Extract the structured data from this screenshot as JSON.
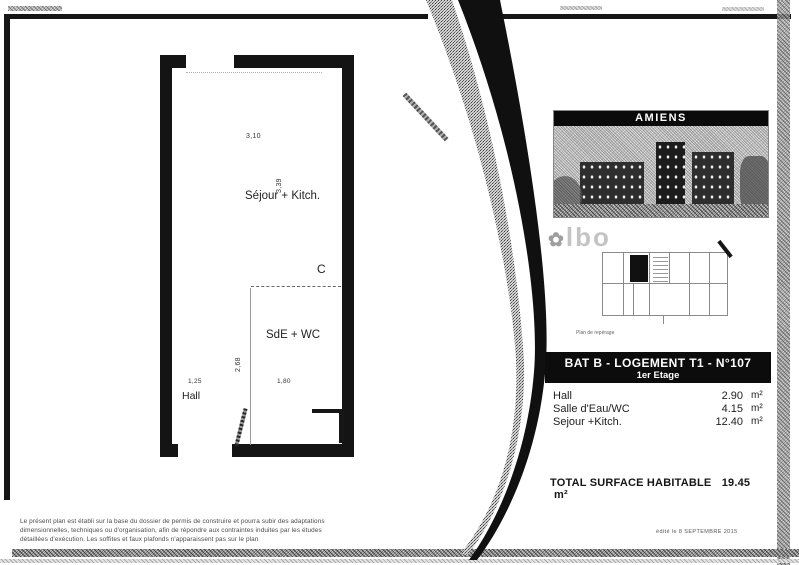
{
  "plan": {
    "rooms": {
      "sejour": {
        "label": "Séjour + Kitch.",
        "width_dim": "3,10",
        "height_dim": "3,39"
      },
      "sde": {
        "label": "SdE + WC",
        "width_dim": "1,80",
        "height_dim": "2,68"
      },
      "hall": {
        "label": "Hall",
        "width_dim": "1,25"
      }
    },
    "marker_c": "C"
  },
  "panel": {
    "photo_title": "AMIENS",
    "logo_text": "lbo",
    "logo_leaf": "✿",
    "keyplan_caption": "Plan de repérage",
    "unit_banner": {
      "line1": "BAT B - LOGEMENT T1 - N°107",
      "line2": "1er Etage"
    },
    "areas": [
      {
        "label": "Hall",
        "value": "2.90",
        "unit": "m²"
      },
      {
        "label": "Salle d'Eau/WC",
        "value": "4.15",
        "unit": "m²"
      },
      {
        "label": "Sejour +Kitch.",
        "value": "12.40",
        "unit": "m²"
      }
    ],
    "total": {
      "label": "TOTAL SURFACE HABITABLE",
      "value": "19.45",
      "unit": "m²"
    },
    "date_note": "édité le 8 SEPTEMBRE 2015"
  },
  "footer": {
    "disclaimer_line1": "Le présent plan est établi sur la base du dossier de permis de construire et pourra subir des adaptations",
    "disclaimer_line2": "dimensionnelles, techniques ou d'organisation, afin de répondre aux contraintes induites par les études",
    "disclaimer_line3": "détaillées d'exécution. Les soffites et faux plafonds n'apparaissent pas sur le plan"
  },
  "colors": {
    "ink": "#161616",
    "paper": "#ffffff",
    "scan_gray": "#9a9a9a"
  }
}
